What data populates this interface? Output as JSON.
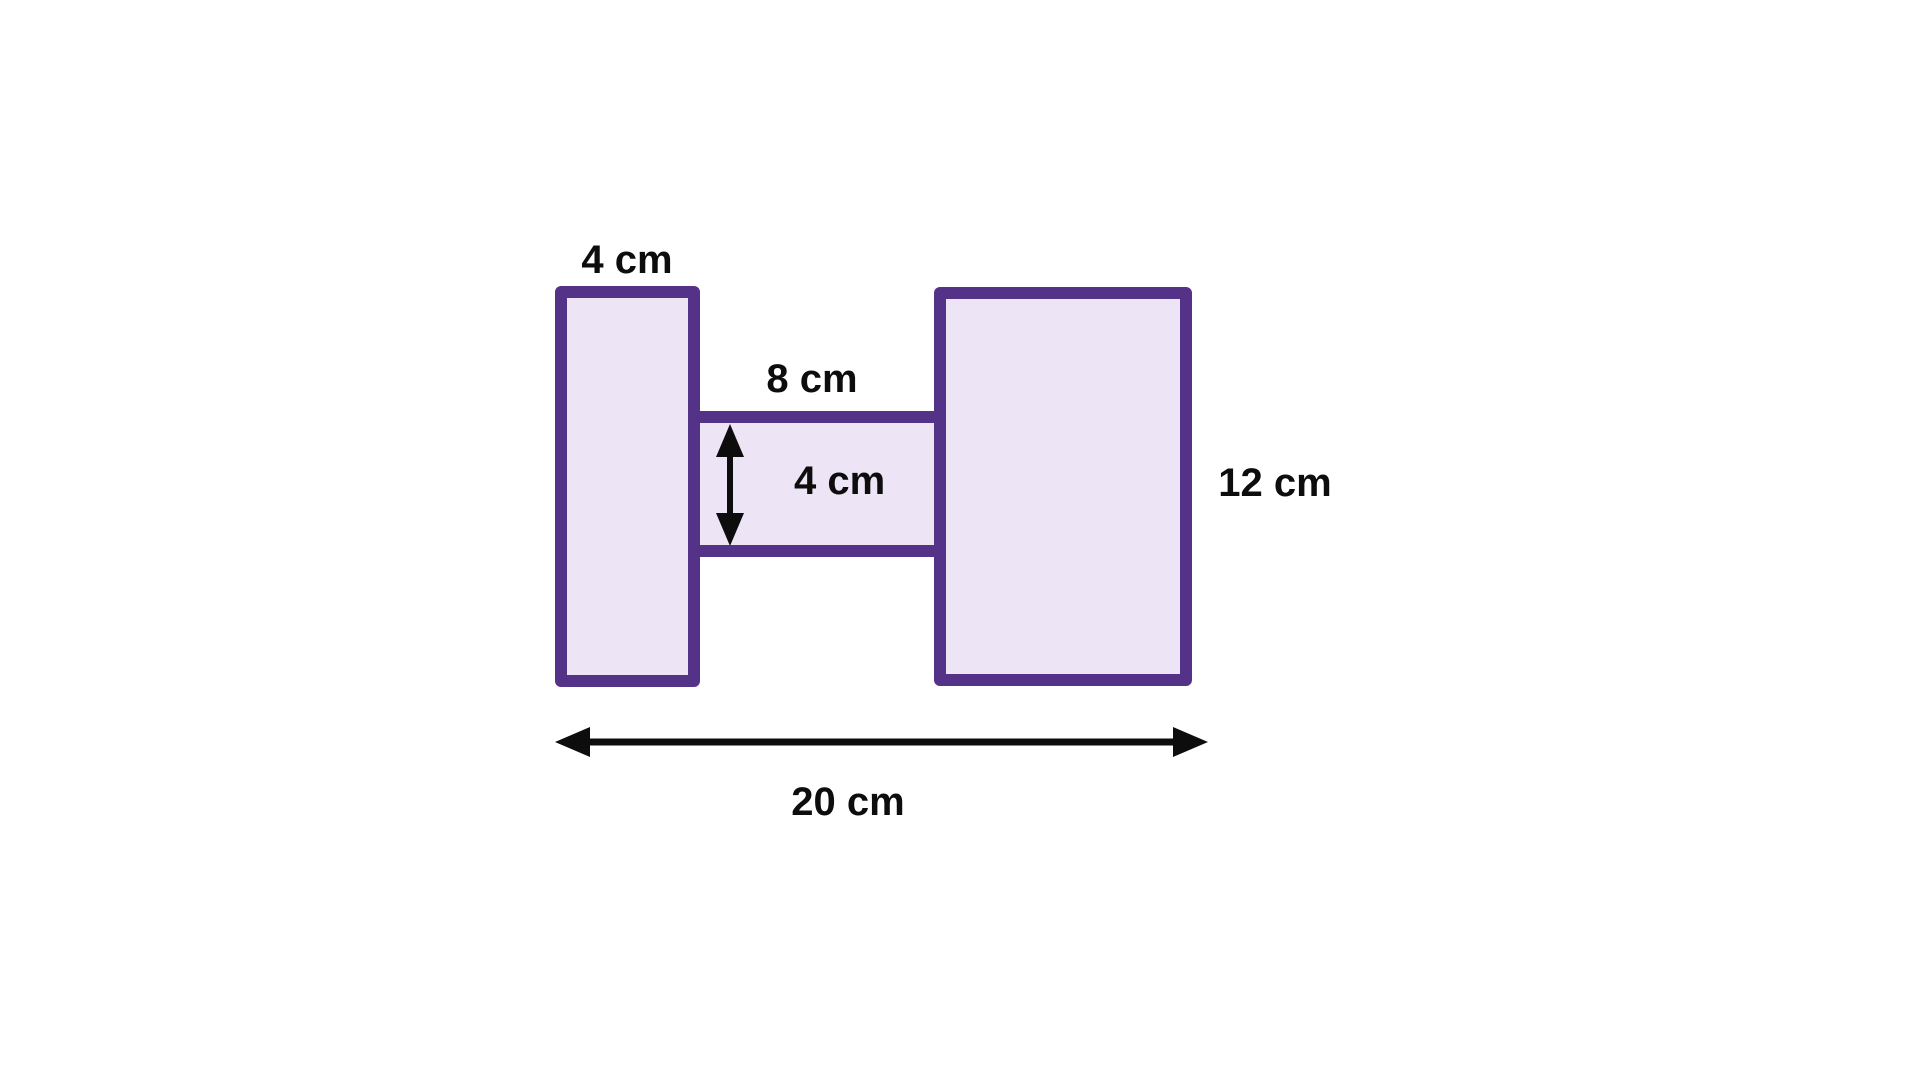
{
  "diagram": {
    "labels": {
      "left_width": "4 cm",
      "connector_length": "8 cm",
      "connector_height": "4 cm",
      "right_height": "12 cm",
      "total_length": "20 cm"
    },
    "dimensions_cm": {
      "left_rectangle_width": 4,
      "left_rectangle_height": 12,
      "connector_length": 8,
      "connector_height": 4,
      "right_rectangle_height": 12,
      "total_length": 20
    },
    "colors": {
      "shape_border": "#543287",
      "shape_fill": "#ede4f6",
      "arrow": "#0d0d0d",
      "label_text": "#0d0d0d",
      "background": "#ffffff"
    }
  }
}
